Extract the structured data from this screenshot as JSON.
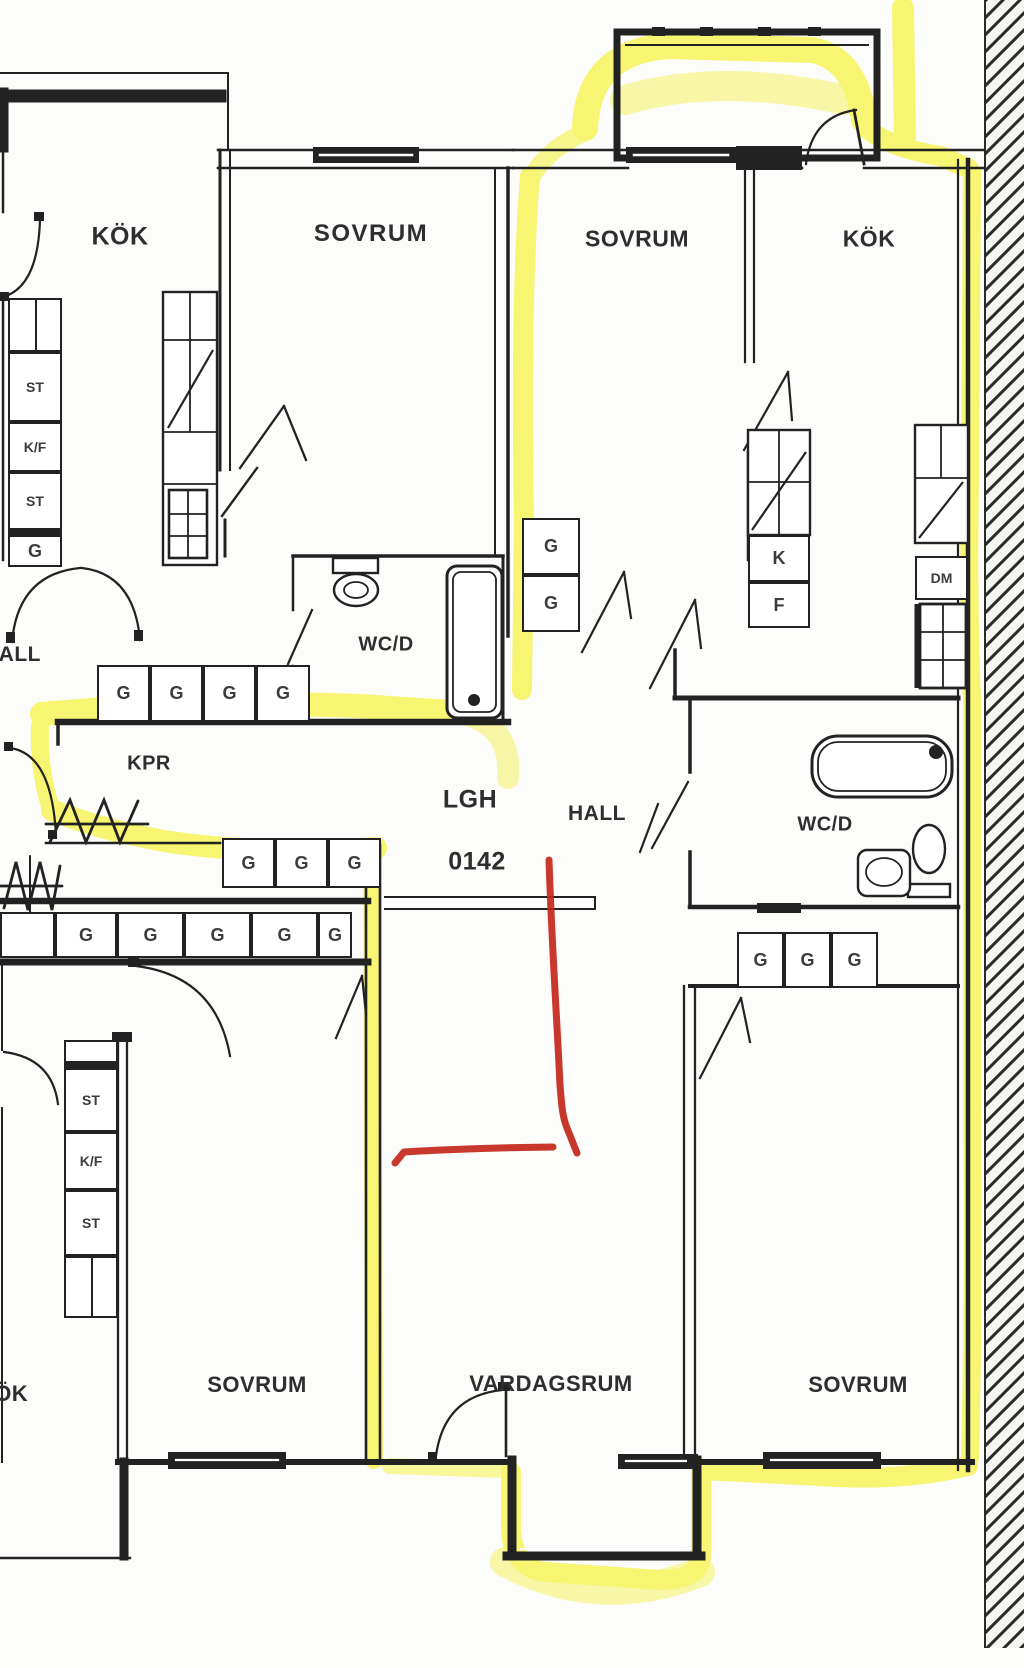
{
  "colors": {
    "wall": "#1f1f1f",
    "highlighter": "#f2ef00",
    "red_pen": "#c3271b",
    "paper": "#fcfcfa"
  },
  "apartment": {
    "id_prefix": "LGH",
    "id_number": "0142"
  },
  "labels": {
    "kok_top_left": {
      "text": "KÖK"
    },
    "sovrum_top_left": {
      "text": "SOVRUM"
    },
    "sovrum_top_middle": {
      "text": "SOVRUM"
    },
    "kok_top_right": {
      "text": "KÖK"
    },
    "wcd_left": {
      "text": "WC/D"
    },
    "hall_upper_left": {
      "text": "HALL"
    },
    "kpr": {
      "text": "KPR"
    },
    "lgh": {
      "text": "LGH"
    },
    "lgh_number": {
      "text": "0142"
    },
    "hall_right": {
      "text": "HALL"
    },
    "wcd_right": {
      "text": "WC/D"
    },
    "kok_bottom_left": {
      "text": "KÖK"
    },
    "sovrum_bottom_left": {
      "text": "SOVRUM"
    },
    "vardagsrum": {
      "text": "VARDAGSRUM"
    },
    "sovrum_bottom_right": {
      "text": "SOVRUM"
    }
  },
  "closet_rows": [
    {
      "name": "entry-utility-column",
      "x": 8,
      "y": 298,
      "dir": "v",
      "w": 54,
      "cells": [
        {
          "label": "",
          "h": 54,
          "divider": "v"
        },
        {
          "label": "ST",
          "h": 70
        },
        {
          "label": "K/F",
          "h": 50
        },
        {
          "label": "ST",
          "h": 58
        },
        {
          "label": "G",
          "h": 37,
          "thick_top": true
        }
      ]
    },
    {
      "name": "upper-hall-wardrobes",
      "x": 97,
      "y": 665,
      "dir": "h",
      "h": 57,
      "cells": [
        {
          "label": "G",
          "w": 53
        },
        {
          "label": "G",
          "w": 53
        },
        {
          "label": "G",
          "w": 53
        },
        {
          "label": "G",
          "w": 54
        }
      ]
    },
    {
      "name": "mid-bedroom-wardrobes",
      "x": 522,
      "y": 518,
      "dir": "v",
      "w": 58,
      "cells": [
        {
          "label": "G",
          "h": 57
        },
        {
          "label": "G",
          "h": 57
        }
      ]
    },
    {
      "name": "right-kitchen-kf",
      "x": 748,
      "y": 535,
      "dir": "v",
      "w": 62,
      "cells": [
        {
          "label": "K",
          "h": 47
        },
        {
          "label": "F",
          "h": 46
        }
      ]
    },
    {
      "name": "right-kitchen-dm",
      "x": 915,
      "y": 556,
      "dir": "v",
      "w": 53,
      "cells": [
        {
          "label": "DM",
          "h": 44
        }
      ]
    },
    {
      "name": "kpr-wardrobes",
      "x": 222,
      "y": 838,
      "dir": "h",
      "h": 50,
      "cells": [
        {
          "label": "G",
          "w": 53
        },
        {
          "label": "G",
          "w": 53
        },
        {
          "label": "G",
          "w": 53
        }
      ]
    },
    {
      "name": "lower-hall-wardrobes",
      "x": 0,
      "y": 912,
      "dir": "h",
      "h": 46,
      "cells": [
        {
          "label": "",
          "w": 55
        },
        {
          "label": "G",
          "w": 62
        },
        {
          "label": "G",
          "w": 67
        },
        {
          "label": "G",
          "w": 67
        },
        {
          "label": "G",
          "w": 67
        },
        {
          "label": "G",
          "w": 34
        }
      ]
    },
    {
      "name": "right-wcd-wardrobes",
      "x": 737,
      "y": 932,
      "dir": "h",
      "h": 56,
      "cells": [
        {
          "label": "G",
          "w": 47
        },
        {
          "label": "G",
          "w": 47
        },
        {
          "label": "G",
          "w": 47
        }
      ]
    },
    {
      "name": "lower-left-utility-column",
      "x": 64,
      "y": 1040,
      "dir": "v",
      "w": 54,
      "cells": [
        {
          "label": "",
          "h": 28,
          "thick_bottom": true
        },
        {
          "label": "ST",
          "h": 64
        },
        {
          "label": "K/F",
          "h": 58
        },
        {
          "label": "ST",
          "h": 66
        },
        {
          "label": "",
          "h": 62,
          "divider": "v"
        }
      ]
    }
  ]
}
